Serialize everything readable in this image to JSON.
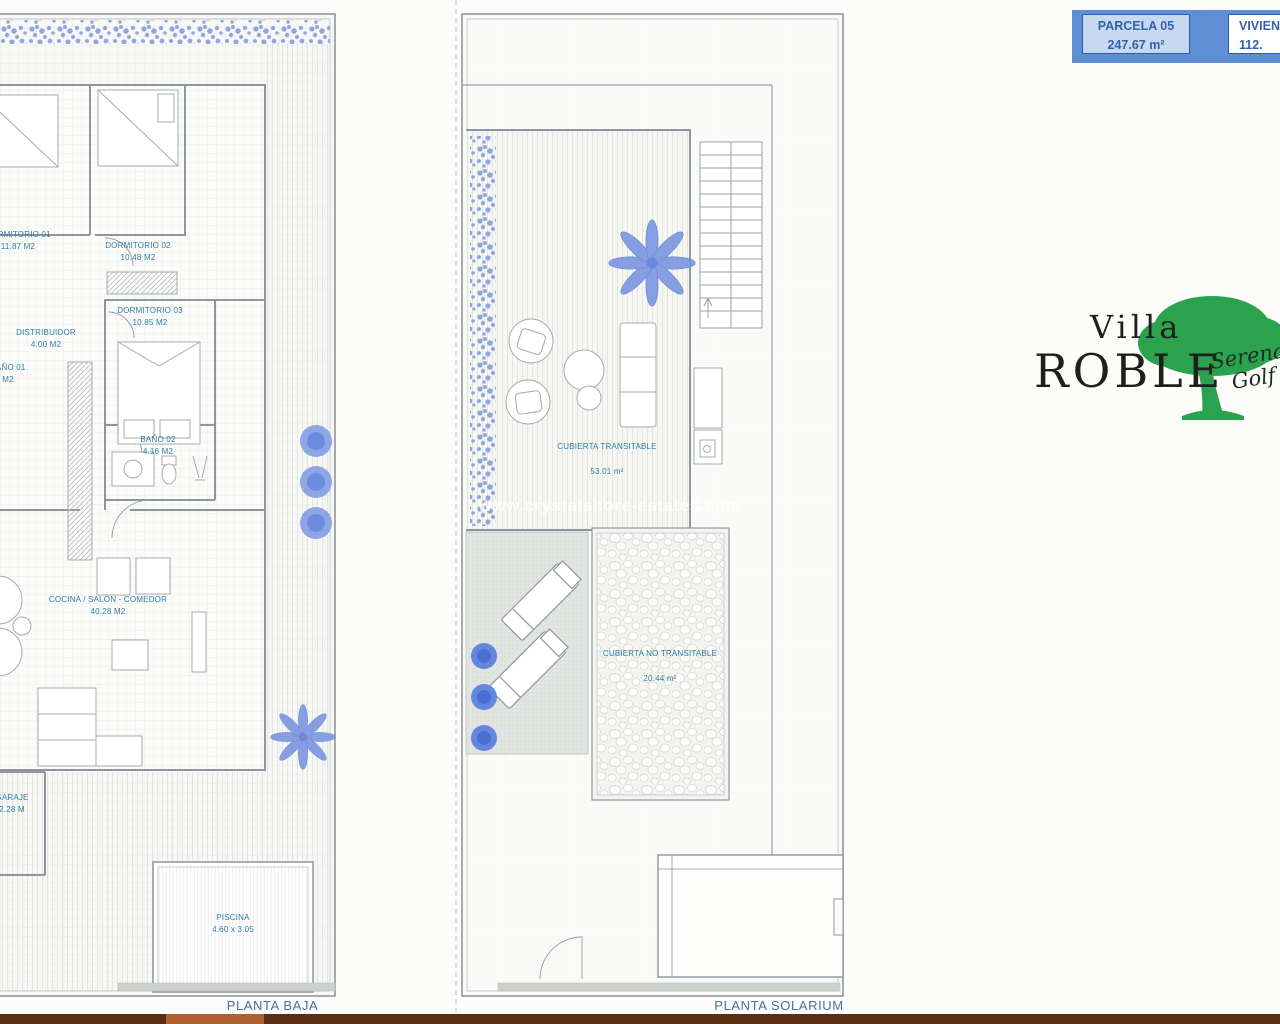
{
  "header": {
    "parcela_label": "PARCELA 05",
    "parcela_area": "247.67 m²",
    "vivienda_label": "VIVIENDA",
    "vivienda_area": "112."
  },
  "logo": {
    "villa": "Villa",
    "roble": "ROBLE",
    "script_line1": "Serena",
    "script_line2": "Golf"
  },
  "watermark": "www.crystalshore-estates.com",
  "plans": {
    "baja": {
      "title": "PLANTA BAJA",
      "rooms": [
        {
          "name": "DORMITORIO 01",
          "area": "11.87 M2"
        },
        {
          "name": "DORMITORIO 02",
          "area": "10.48 M2"
        },
        {
          "name": "DORMITORIO 03",
          "area": "10.85 M2"
        },
        {
          "name": "DISTRIBUIDOR",
          "area": "4.00 M2"
        },
        {
          "name": "BAÑO 01",
          "area": "M2"
        },
        {
          "name": "BAÑO 02",
          "area": "4.16 M2"
        },
        {
          "name": "COCINA / SALÓN - COMEDOR",
          "area": "40.28 M2"
        },
        {
          "name": "GARAJE",
          "area": "2.28 M"
        },
        {
          "name": "PISCINA",
          "area": "4.60 x 3.05"
        }
      ]
    },
    "solarium": {
      "title": "PLANTA SOLARIUM",
      "rooms": [
        {
          "name": "CUBIERTA TRANSITABLE",
          "area": "53.01 m²"
        },
        {
          "name": "CUBIERTA NO TRANSITABLE",
          "area": "20.44 m²"
        }
      ]
    }
  },
  "colors": {
    "header_blue": "#5e8fd6",
    "header_box_blue": "#c7d9f1",
    "label_teal": "#2e7ca6",
    "plan_title_blue": "#49709a",
    "plant_blue": "#7b95e2",
    "bush_blue": "#5d7ed8",
    "logo_green": "#2ba24e",
    "bottom_bar_brown": "#5b2d13"
  }
}
